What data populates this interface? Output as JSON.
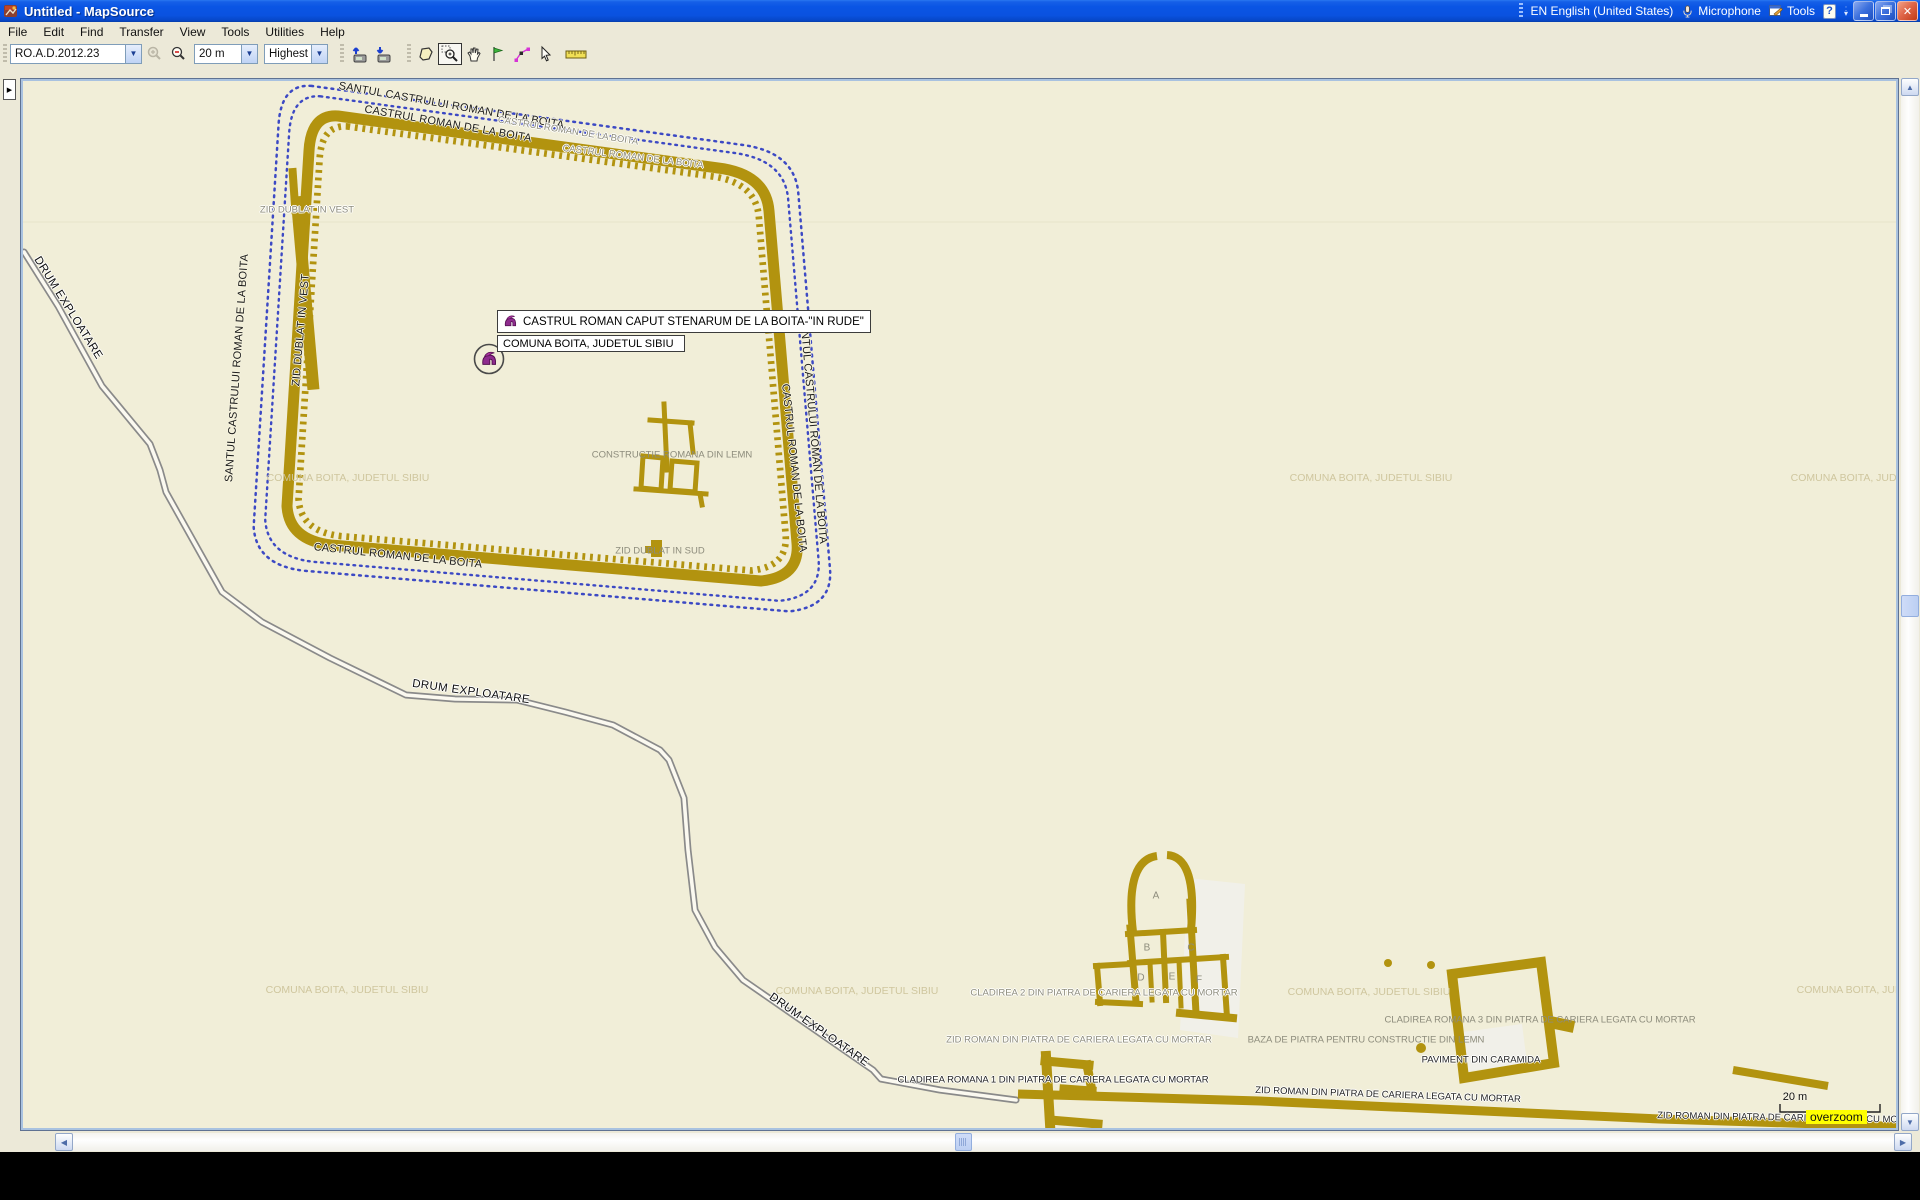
{
  "window": {
    "title": "Untitled - MapSource"
  },
  "language_bar": {
    "language": "EN English (United States)",
    "microphone": "Microphone",
    "tools": "Tools"
  },
  "menu": {
    "items": [
      "File",
      "Edit",
      "Find",
      "Transfer",
      "View",
      "Tools",
      "Utilities",
      "Help"
    ]
  },
  "toolbar": {
    "product": "RO.A.D.2012.23",
    "zoom_scale": "20 m",
    "detail": "Highest"
  },
  "tooltip": {
    "title": "CASTRUL ROMAN CAPUT STENARUM DE LA BOITA-\"IN RUDE\"",
    "subtitle": "COMUNA BOITA, JUDETUL SIBIU"
  },
  "scale_bar": {
    "label": "20 m",
    "overzoom": "overzoom"
  },
  "colors": {
    "title_blue": "#0f5ae0",
    "chrome": "#ece9d8",
    "map_bg": "#f1eed8",
    "wall": "#b2930f",
    "ditch_blue": "#3c49c4",
    "road_casing": "#8a8a8a",
    "road_fill": "#fbf9f0",
    "label_gray": "#8d8c7c",
    "label_faint": "#cfc69e",
    "helmet_purple": "#8e2b8e",
    "overzoom_bg": "#ffff00",
    "selection_border": "#7f9db9"
  },
  "map": {
    "offset_x": 23,
    "offset_y": 81,
    "labels": [
      {
        "text": "SANTUL CASTRULUI ROMAN DE LA BOITA.",
        "x": 453,
        "y": 106,
        "r": 10,
        "cls": "lab-black"
      },
      {
        "text": "CASTRUL ROMAN DE LA BOITA",
        "x": 448,
        "y": 124,
        "r": 10,
        "cls": "lab-black"
      },
      {
        "text": "CASTRUL ROMAN DE LA BOITA",
        "x": 568,
        "y": 131,
        "r": 9,
        "cls": "lab-grayhalo"
      },
      {
        "text": "CASTRUL ROMAN DE LA BOITA",
        "x": 633,
        "y": 157,
        "r": 7,
        "cls": "lab-grayhalo"
      },
      {
        "text": "SANTUL CASTRULUI ROMAN DE LA BOITA",
        "x": 237,
        "y": 368,
        "r": -86,
        "cls": "lab-black"
      },
      {
        "text": "ZID DUBLAT IN VEST",
        "x": 307,
        "y": 210,
        "r": 0,
        "cls": "lab-grayhalo"
      },
      {
        "text": "ZID DUBLAT IN VEST",
        "x": 301,
        "y": 330,
        "r": -85,
        "cls": "lab-black"
      },
      {
        "text": "SANTUL CASTRULUI ROMAN DE LA BOITA",
        "x": 813,
        "y": 430,
        "r": 85,
        "cls": "lab-black"
      },
      {
        "text": "CASTRUL ROMAN DE LA BOITA",
        "x": 794,
        "y": 468,
        "r": 84,
        "cls": "lab-black"
      },
      {
        "text": "CASTRUL ROMAN DE LA BOITA",
        "x": 398,
        "y": 556,
        "r": 6,
        "cls": "lab-black"
      },
      {
        "text": "CONSTRUCTIE ROMANA DIN LEMN",
        "x": 672,
        "y": 455,
        "r": 0,
        "cls": "lab-gray"
      },
      {
        "text": "ZID DUBLAT IN SUD",
        "x": 660,
        "y": 551,
        "r": 0,
        "cls": "lab-gray"
      },
      {
        "text": "COMUNA BOITA, JUDETUL SIBIU",
        "x": 348,
        "y": 478,
        "r": 0,
        "cls": "lab-faint"
      },
      {
        "text": "COMUNA BOITA, JUDETUL SIBIU",
        "x": 1371,
        "y": 478,
        "r": 0,
        "cls": "lab-faint"
      },
      {
        "text": "COMUNA BOITA, JUDETUL SIBIU",
        "x": 1872,
        "y": 478,
        "r": 0,
        "cls": "lab-faint"
      },
      {
        "text": "COMUNA BOITA, JUDETUL SIBIU",
        "x": 347,
        "y": 990,
        "r": 0,
        "cls": "lab-faint"
      },
      {
        "text": "COMUNA BOITA, JUDETUL SIBIU",
        "x": 857,
        "y": 991,
        "r": 0,
        "cls": "lab-faint"
      },
      {
        "text": "COMUNA BOITA, JUDETUL SIBIU",
        "x": 1369,
        "y": 992,
        "r": 0,
        "cls": "lab-faint"
      },
      {
        "text": "COMUNA BOITA, JUDETUL SIBIU",
        "x": 1878,
        "y": 990,
        "r": 0,
        "cls": "lab-faint"
      },
      {
        "text": "DRUM EXPLOATARE",
        "x": 68,
        "y": 308,
        "r": 58,
        "cls": "lab-road"
      },
      {
        "text": "DRUM EXPLOATARE",
        "x": 471,
        "y": 692,
        "r": 8,
        "cls": "lab-road"
      },
      {
        "text": "DRUM EXPLOATARE",
        "x": 819,
        "y": 1030,
        "r": 35,
        "cls": "lab-road"
      },
      {
        "text": "CLADIREA 2 DIN PIATRA DE CARIERA LEGATA CU MORTAR",
        "x": 1104,
        "y": 993,
        "r": 0,
        "cls": "lab-grayhalo"
      },
      {
        "text": "ZID ROMAN DIN PIATRA DE CARIERA LEGATA CU MORTAR",
        "x": 1079,
        "y": 1040,
        "r": 0,
        "cls": "lab-grayhalo"
      },
      {
        "text": "CLADIREA ROMANA 1 DIN PIATRA DE CARIERA LEGATA CU MORTAR",
        "x": 1053,
        "y": 1080,
        "r": 0,
        "cls": "lab-halo"
      },
      {
        "text": "ZID ROMAN DIN PIATRA DE CARIERA LEGATA CU MORTAR",
        "x": 1388,
        "y": 1095,
        "r": 2,
        "cls": "lab-halo"
      },
      {
        "text": "CLADIREA ROMANA 3 DIN PIATRA DE CARIERA LEGATA CU MORTAR",
        "x": 1540,
        "y": 1020,
        "r": 0,
        "cls": "lab-gray"
      },
      {
        "text": "BAZA DE PIATRA PENTRU CONSTRUCTIE DIN LEMN",
        "x": 1366,
        "y": 1040,
        "r": 0,
        "cls": "lab-gray"
      },
      {
        "text": "PAVIMENT DIN CARAMIDA",
        "x": 1481,
        "y": 1060,
        "r": 0,
        "cls": "lab-halo"
      },
      {
        "text": "ZID ROMAN DIN PIATRA DE CARIERA LEGATA CU MORTAR",
        "x": 1790,
        "y": 1118,
        "r": 1,
        "cls": "lab-halo"
      },
      {
        "text": "A",
        "x": 1156,
        "y": 896,
        "r": 0,
        "cls": "lab-room"
      },
      {
        "text": "B",
        "x": 1147,
        "y": 948,
        "r": 0,
        "cls": "lab-room"
      },
      {
        "text": "C",
        "x": 1191,
        "y": 948,
        "r": 0,
        "cls": "lab-room"
      },
      {
        "text": "D",
        "x": 1141,
        "y": 978,
        "r": 0,
        "cls": "lab-room"
      },
      {
        "text": "E",
        "x": 1172,
        "y": 977,
        "r": 0,
        "cls": "lab-room"
      },
      {
        "text": "F",
        "x": 1199,
        "y": 980,
        "r": 0,
        "cls": "lab-room"
      },
      {
        "text": "20 m",
        "x": 1795,
        "y": 1097,
        "r": 0,
        "cls": "lab-scale"
      }
    ]
  }
}
